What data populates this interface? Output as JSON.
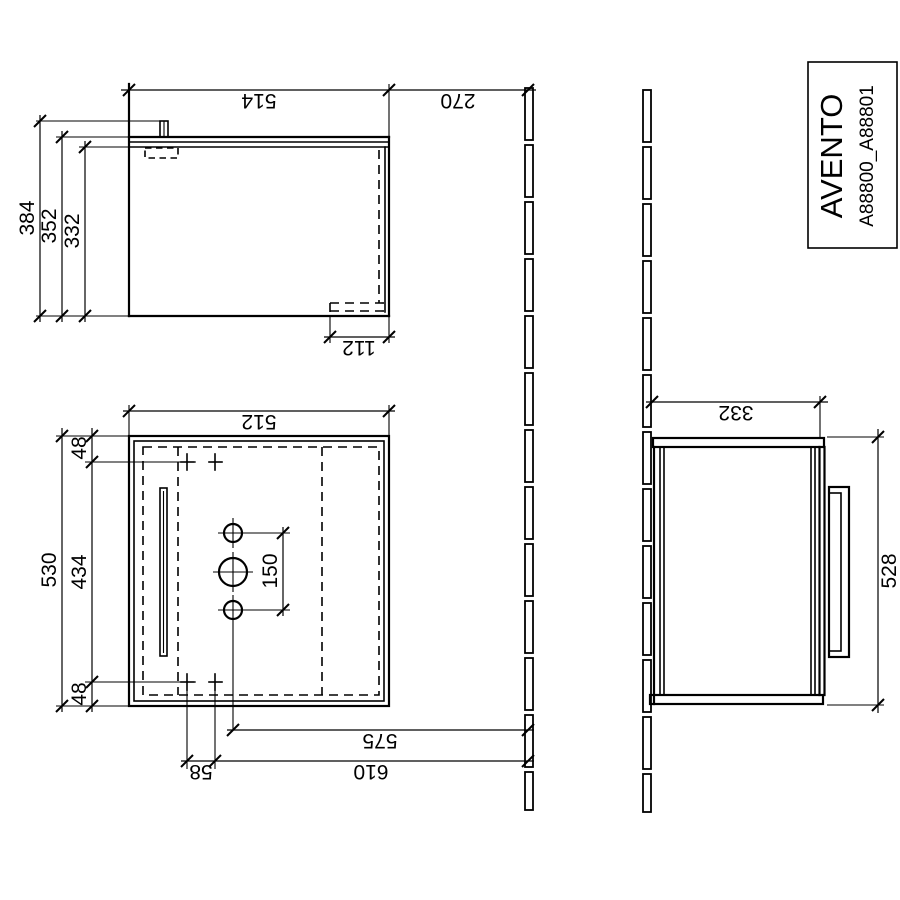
{
  "title_block": {
    "series": "AVENTO",
    "articles": "A88800_A88801"
  },
  "side_view": {
    "overall_height": "514",
    "distance_to_floor": "270",
    "depth_incl_rail": "384",
    "depth_incl_top": "352",
    "depth_body": "332",
    "recess_height": "112"
  },
  "front_view": {
    "body_height": "512",
    "width_total": "530",
    "side_margin_top": "48",
    "fixing_span": "434",
    "side_margin_bottom": "48",
    "hole_spacing": "150",
    "drain_distance": "575",
    "fixing_distance": "610",
    "fixing_pair_offset": "58"
  },
  "top_view": {
    "depth": "332",
    "width": "528"
  },
  "colors": {
    "line": "#000000",
    "background": "#ffffff"
  }
}
